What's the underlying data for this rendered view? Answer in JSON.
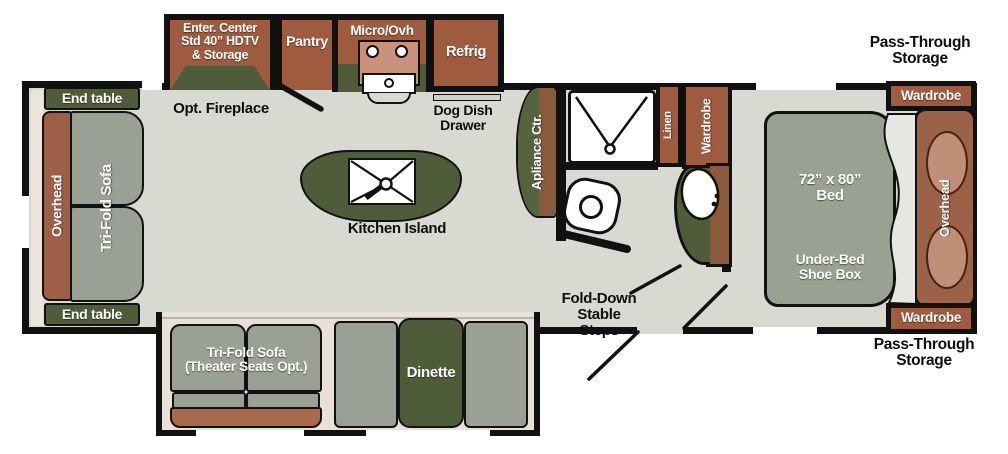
{
  "plan": {
    "rear_slide": {
      "end_table_top": "End table",
      "overhead": "Overhead",
      "sofa": "Tri-Fold Sofa",
      "end_table_bottom": "End table"
    },
    "galley": {
      "entertainment": "Enter. Center\nStd 40” HDTV\n& Storage",
      "fireplace_note": "Opt. Fireplace",
      "pantry": "Pantry",
      "micro": "Micro/Ovh",
      "refrig": "Refrig",
      "dog_dish": "Dog Dish\nDrawer",
      "island": "Kitchen Island",
      "appliance_center": "Apliance Ctr."
    },
    "bottom_slide": {
      "sofa": "Tri-Fold Sofa\n(Theater Seats Opt.)",
      "dinette": "Dinette"
    },
    "bath": {
      "linen": "Linen",
      "wardrobe": "Wardrobe"
    },
    "entry": {
      "steps": "Fold-Down\nStable\nSteps"
    },
    "bedroom": {
      "bed": "72” x 80”\nBed",
      "under_bed": "Under-Bed\nShoe Box",
      "overhead": "Overhead",
      "wardrobe_top": "Wardrobe",
      "wardrobe_bottom": "Wardrobe",
      "pass_through_top": "Pass-Through\nStorage",
      "pass_through_bottom": "Pass-Through\nStorage"
    }
  },
  "colors": {
    "wall": "#111111",
    "floor": "#d8dad1",
    "cabinet_brown": "#9e5b3e",
    "accent_green": "#4e5c39",
    "furniture_gray": "#9aa094",
    "sofa_front_rust": "#aa6a4d",
    "headboard_brown": "#9b6247",
    "pillow_tan": "#c18f77",
    "stove_tan": "#c8917c",
    "slide_liner": "#e9e1d8"
  }
}
